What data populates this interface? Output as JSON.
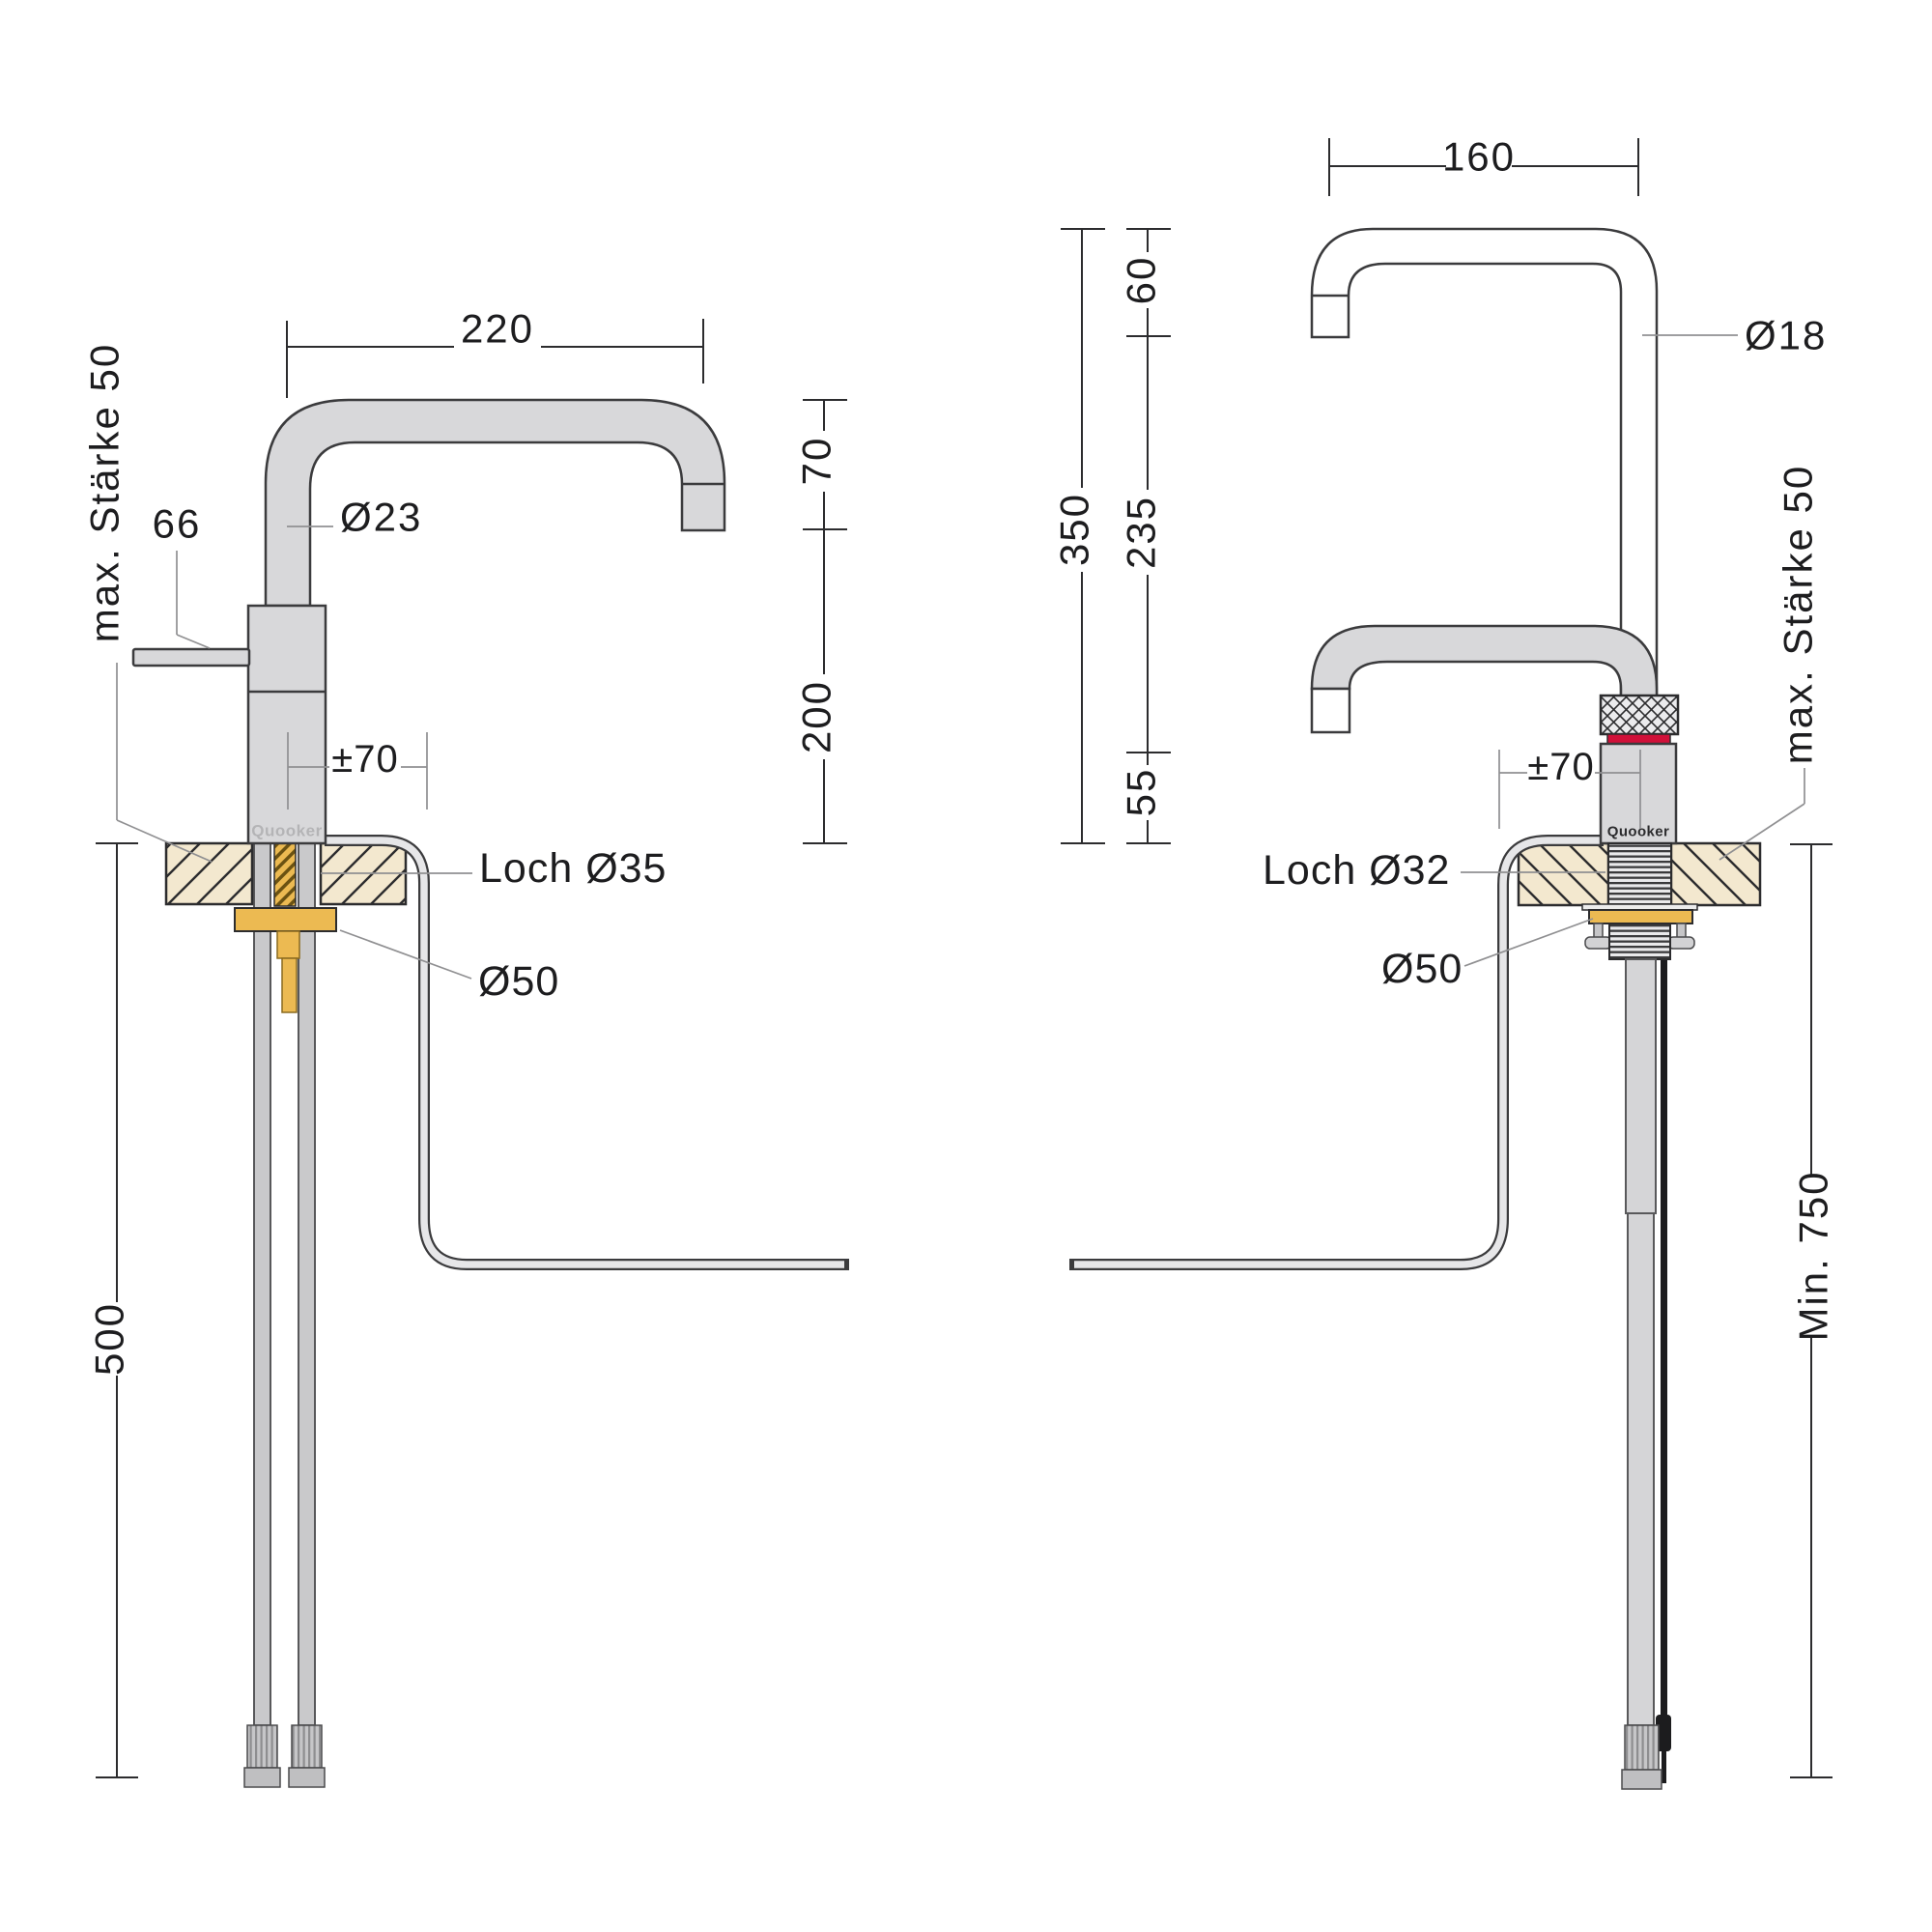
{
  "brand": {
    "logo": "Quooker"
  },
  "left_view": {
    "logo": "Quooker",
    "dim_reach": "220",
    "dim_spout_drop": "70",
    "dim_spout_height": "200",
    "dim_handle_length": "66",
    "dim_pipe_diameter": "Ø23",
    "dim_swivel_offset": "±70",
    "label_worktop_thickness": "max. Stärke 50",
    "label_hole": "Loch Ø35",
    "label_flange_diameter": "Ø50",
    "dim_hose_length": "500"
  },
  "right_view": {
    "logo": "Quooker",
    "dim_reach": "160",
    "dim_total_height": "350",
    "dim_segment_top": "60",
    "dim_segment_middle": "235",
    "dim_segment_bottom": "55",
    "dim_pipe_diameter": "Ø18",
    "dim_swivel_offset": "±70",
    "label_worktop_thickness": "max. Stärke 50",
    "label_hole": "Loch Ø32",
    "label_flange_diameter": "Ø50",
    "dim_hose_min_length": "Min. 750"
  },
  "colors": {
    "accent_red": "#d11039",
    "brass": "#ecba52",
    "worktop_beige": "#f3e8cf",
    "steel_gray": "#d8d8da"
  }
}
